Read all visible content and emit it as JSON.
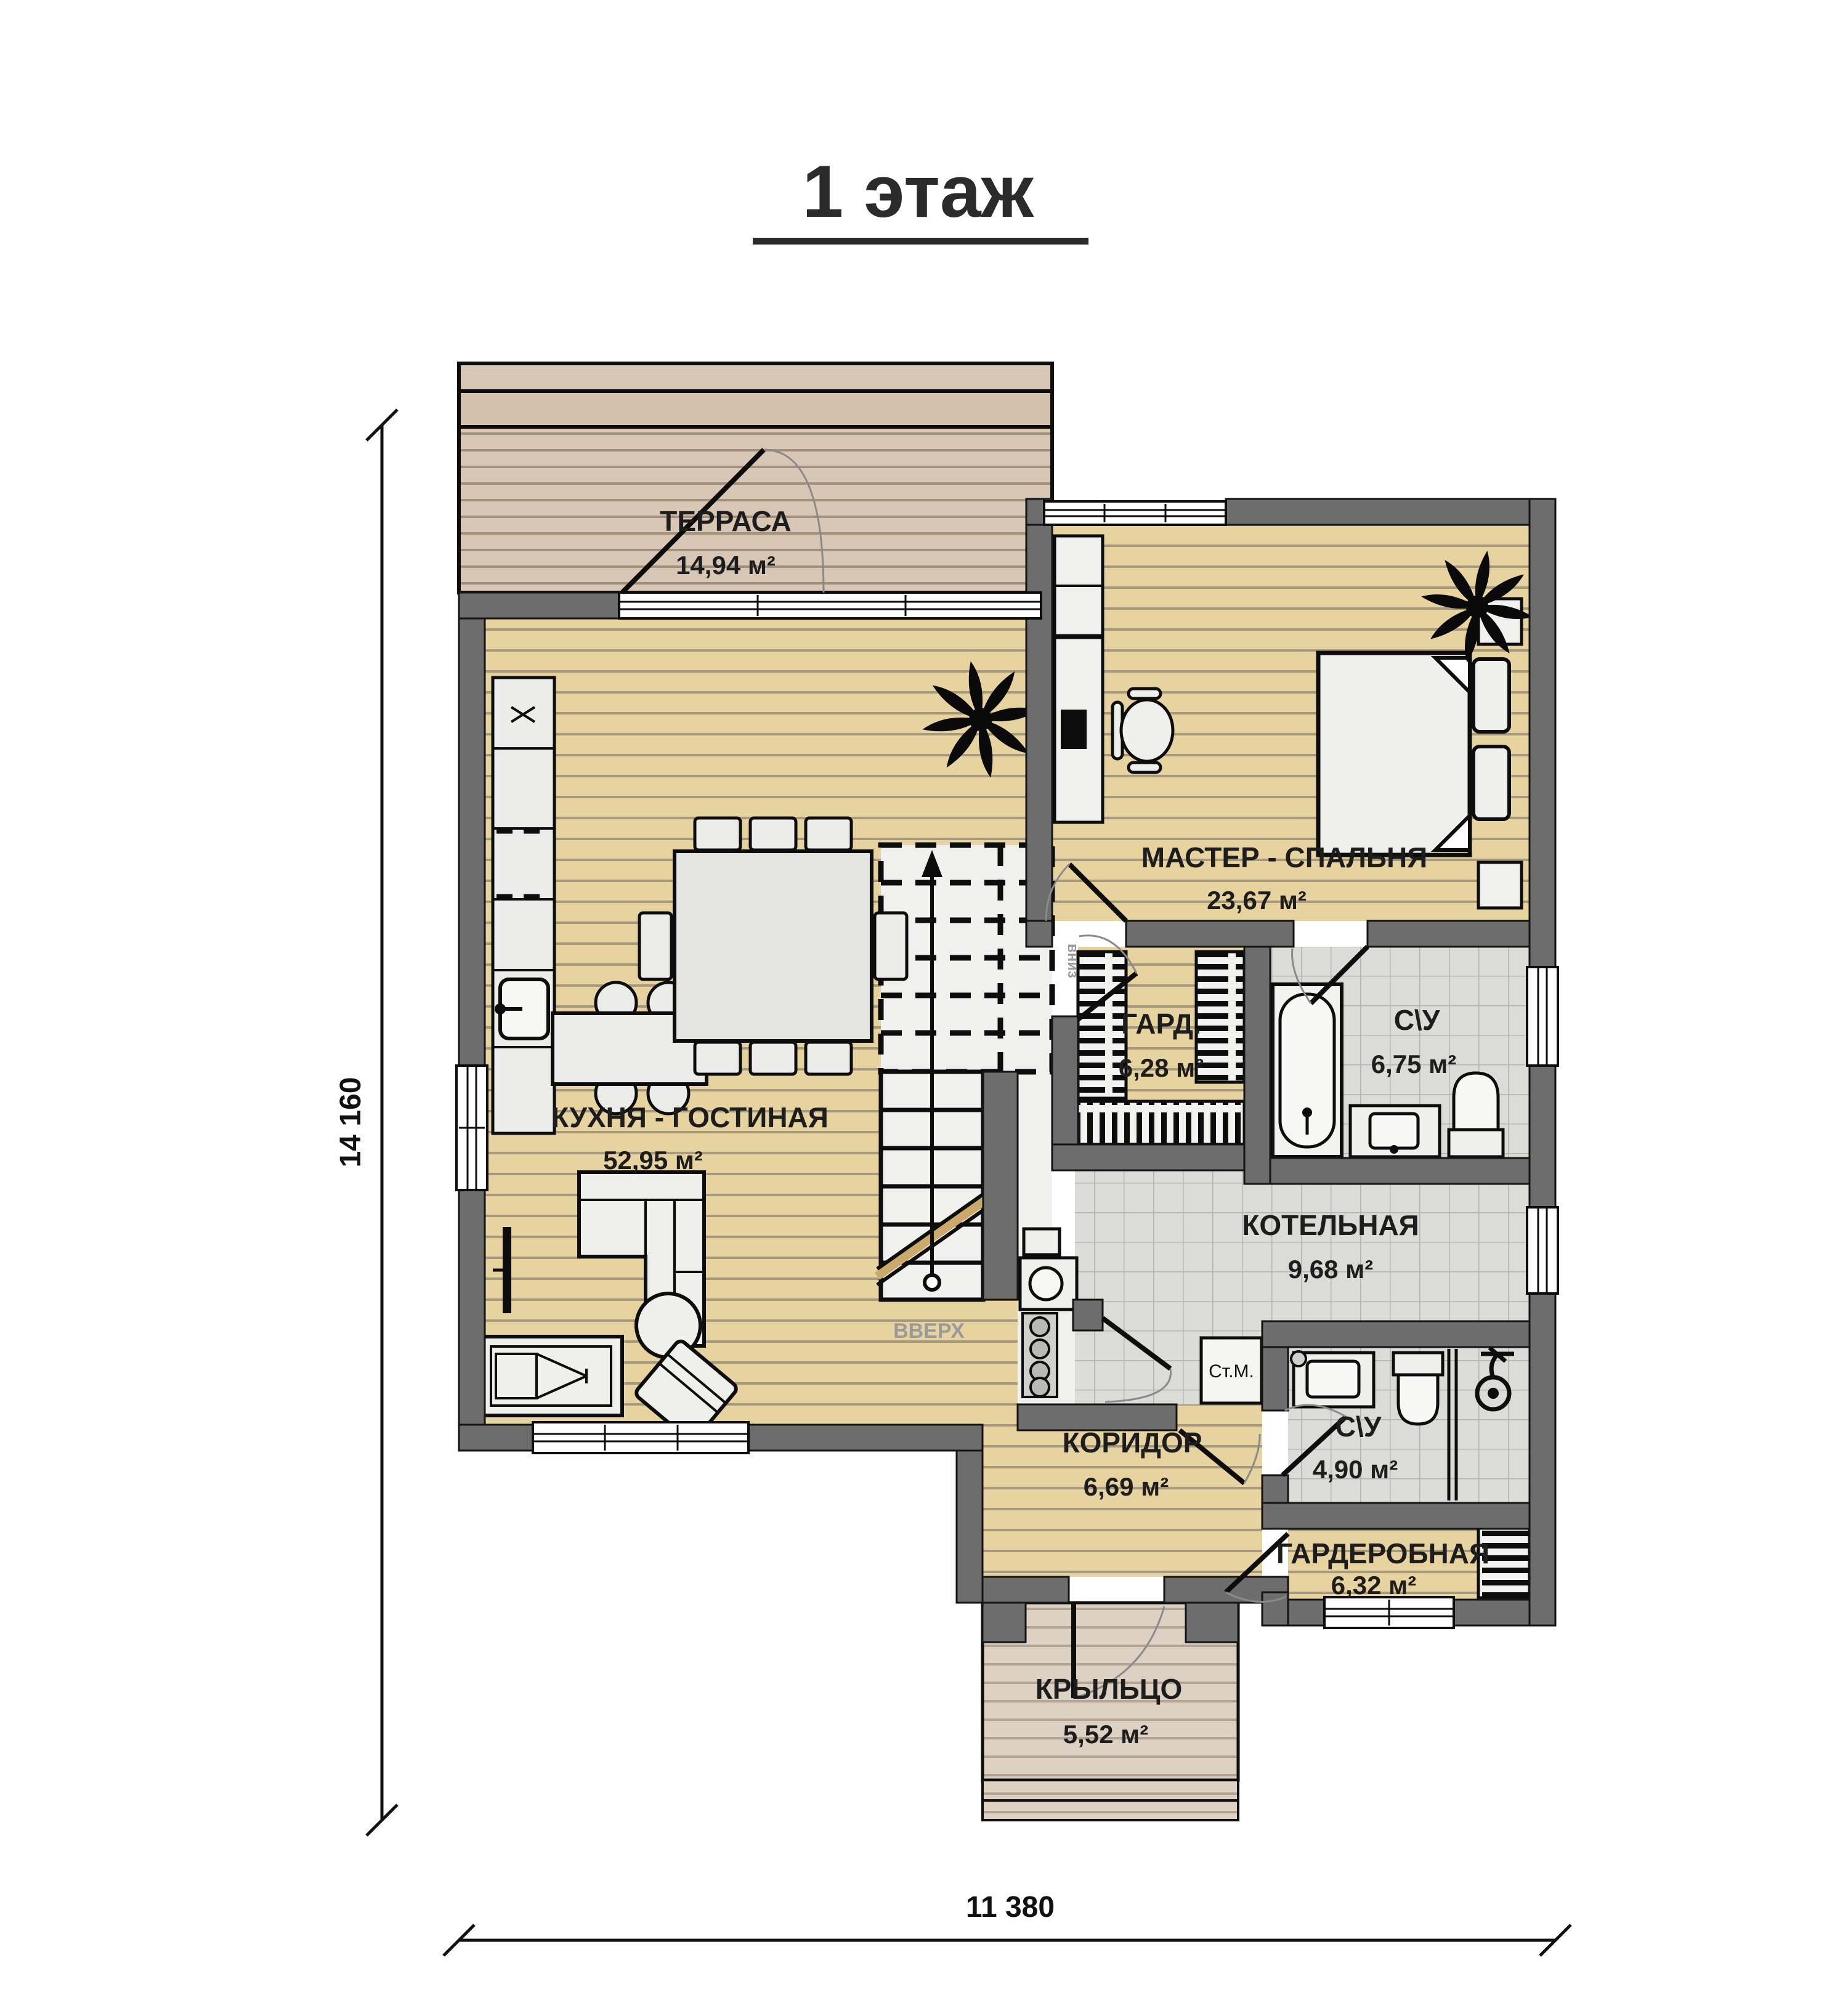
{
  "title": "1 этаж",
  "rooms": {
    "terrace": {
      "name": "ТЕРРАСА",
      "area": "14,94 м²"
    },
    "kitchen_living": {
      "name": "КУХНЯ - ГОСТИНАЯ",
      "area": "52,95 м²"
    },
    "master_bedroom": {
      "name": "МАСТЕР - СПАЛЬНЯ",
      "area": "23,67 м²"
    },
    "wardrobe": {
      "name": "ГАРД.",
      "area": "6,28 м²"
    },
    "bathroom_1": {
      "name": "С\\У",
      "area": "6,75 м²"
    },
    "boiler_room": {
      "name": "КОТЕЛЬНАЯ",
      "area": "9,68 м²"
    },
    "bathroom_2": {
      "name": "С\\У",
      "area": "4,90 м²"
    },
    "corridor": {
      "name": "КОРИДОР",
      "area": "6,69 м²"
    },
    "walk_in_closet": {
      "name": "ГАРДЕРОБНАЯ",
      "area": "6,32 м²"
    },
    "porch": {
      "name": "КРЫЛЬЦО",
      "area": "5,52 м²"
    }
  },
  "annotations": {
    "stairs_up": "ВВЕРХ",
    "stairs_down": "вниз",
    "washing_machine": "Ст.М."
  },
  "dimensions": {
    "total_height": "14 160",
    "total_width": "11 380"
  },
  "colors": {
    "wall": "#6d6d6d",
    "interior_wood": "#e7d3a0",
    "terrace_wood": "#d8c7b5",
    "porch_wood": "#ddd1c3",
    "tile": "#dbdbd8",
    "label_text": "#1d1d1d",
    "stair_text": "#9a9a9a"
  }
}
